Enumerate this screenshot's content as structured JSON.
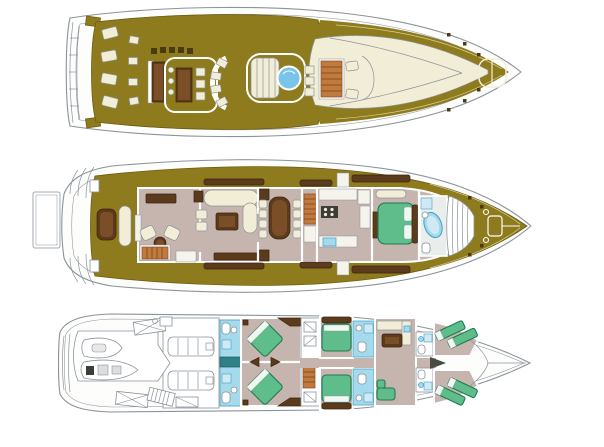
{
  "diagram": {
    "title": "Motor yacht general arrangement plan - three decks",
    "decks": [
      {
        "id": "sun-deck",
        "name": "Sun deck / flybridge",
        "features": [
          "aft staircase",
          "radar arch",
          "sun loungers",
          "wet bar with stools",
          "dinette with table",
          "curved sofa",
          "slatted sun pad",
          "jacuzzi",
          "helm seats",
          "companionway stairs",
          "windshield",
          "foredeck",
          "bow sun pad",
          "cleats"
        ]
      },
      {
        "id": "main-deck",
        "name": "Main deck",
        "features": [
          "swim platform",
          "stern stairs",
          "aft deck table and bench",
          "aft lounge with armchairs and bar",
          "salon sofa and coffee table",
          "dining table with eight chairs",
          "staircase",
          "galley with stove and sink",
          "master stateroom with double bed",
          "master bathroom with tub",
          "bow lounge seating",
          "anchor winch foredeck",
          "side deck windows"
        ]
      },
      {
        "id": "lower-deck",
        "name": "Lower deck",
        "features": [
          "garage with tender and jet ski",
          "stowage crates",
          "aft stairs",
          "engine room with twin engines",
          "VIP en-suite bathrooms",
          "two VIP cabins with diagonal double beds",
          "lobby with staircase and closets",
          "two guest cabins with double beds",
          "guest bathrooms",
          "crew mess with table and bench",
          "crew bathrooms",
          "crew cabins with bunks",
          "bow locker"
        ]
      }
    ]
  },
  "colors": {
    "background": "#ffffff",
    "white": "#ffffff",
    "line": "#8b939b",
    "gold": "#8e7b1d",
    "goldDark": "#6d5c0f",
    "cream": "#f2edd6",
    "taupe": "#c6b5ae",
    "woodDark": "#5c3a1c",
    "woodLight": "#c07a3e",
    "green": "#5fbd8c",
    "greenDark": "#1f7a52",
    "blue": "#a5d9ec",
    "blueDark": "#3f9fc4",
    "jacuzzi": "#7ac4ea",
    "teal": "#2f7f86",
    "dark": "#3c3c38"
  }
}
